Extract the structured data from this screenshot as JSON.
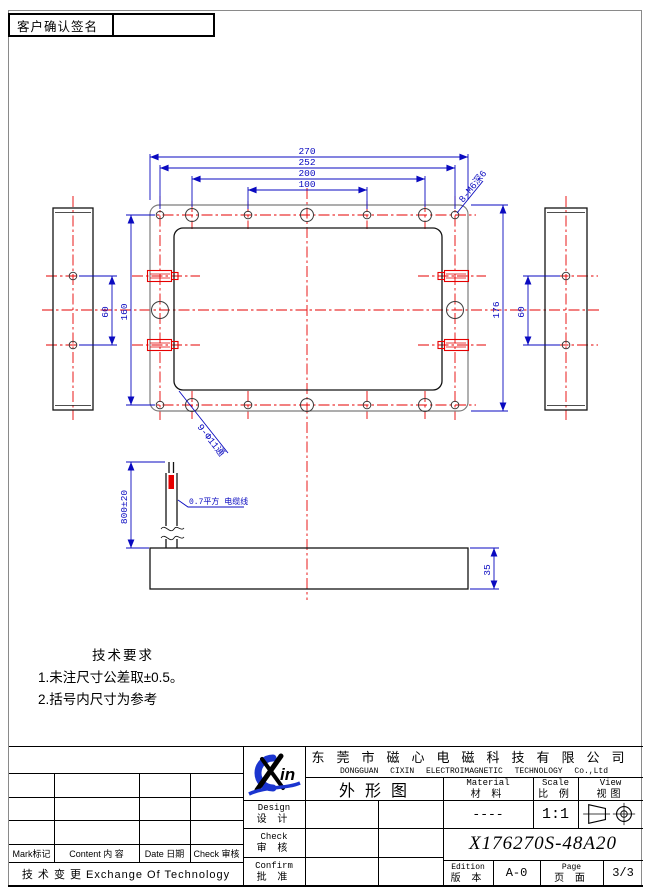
{
  "signature": {
    "label": "客户确认签名"
  },
  "drawing": {
    "dims": {
      "w270": "270",
      "w252": "252",
      "w200": "200",
      "w100": "100",
      "h160": "160",
      "h176": "176",
      "left_60": "60",
      "right_60": "60",
      "t35": "35",
      "cable_len": "800±20"
    },
    "notes": {
      "thread": "8-M6深6",
      "through": "9-Φ11通",
      "cable": "0.7平方 电缆线"
    },
    "tech": {
      "title": "技术要求",
      "line1": "1.未注尺寸公差取±0.5。",
      "line2": "2.括号内尺寸为参考"
    }
  },
  "title_block": {
    "company_cn": "东莞市磁心电磁科技有限公司",
    "company_en": "DONGGUAN CIXIN ELECTROIMAGNETIC TECHNOLOGY Co.,Ltd",
    "logo_text": "in",
    "doc_type": "外形图",
    "material": {
      "en": "Material",
      "cn": "材 料",
      "value": "----"
    },
    "scale": {
      "en": "Scale",
      "cn": "比 例",
      "value": "1:1"
    },
    "view": {
      "en": "View",
      "cn": "视图"
    },
    "design": {
      "en": "Design",
      "cn": "设 计"
    },
    "check": {
      "en": "Check",
      "cn": "审 核"
    },
    "confirm": {
      "en": "Confirm",
      "cn": "批 准"
    },
    "part_number": "X176270S-48A20",
    "edition": {
      "en": "Edition",
      "cn": "版 本",
      "value": "A-0"
    },
    "page": {
      "en": "Page",
      "cn": "页 面",
      "value": "3/3"
    },
    "revision": {
      "mark": "Mark标记",
      "content": "Content 内 容",
      "date": "Date 日期",
      "check": "Check 审核",
      "exchange": "技 术 变 更  Exchange Of Technology"
    }
  },
  "colors": {
    "dimension_blue": "#0a0ac0",
    "centerline_red": "#e60000",
    "outline_gray": "#7c7c7c",
    "logo_blue": "#1b35cf"
  }
}
